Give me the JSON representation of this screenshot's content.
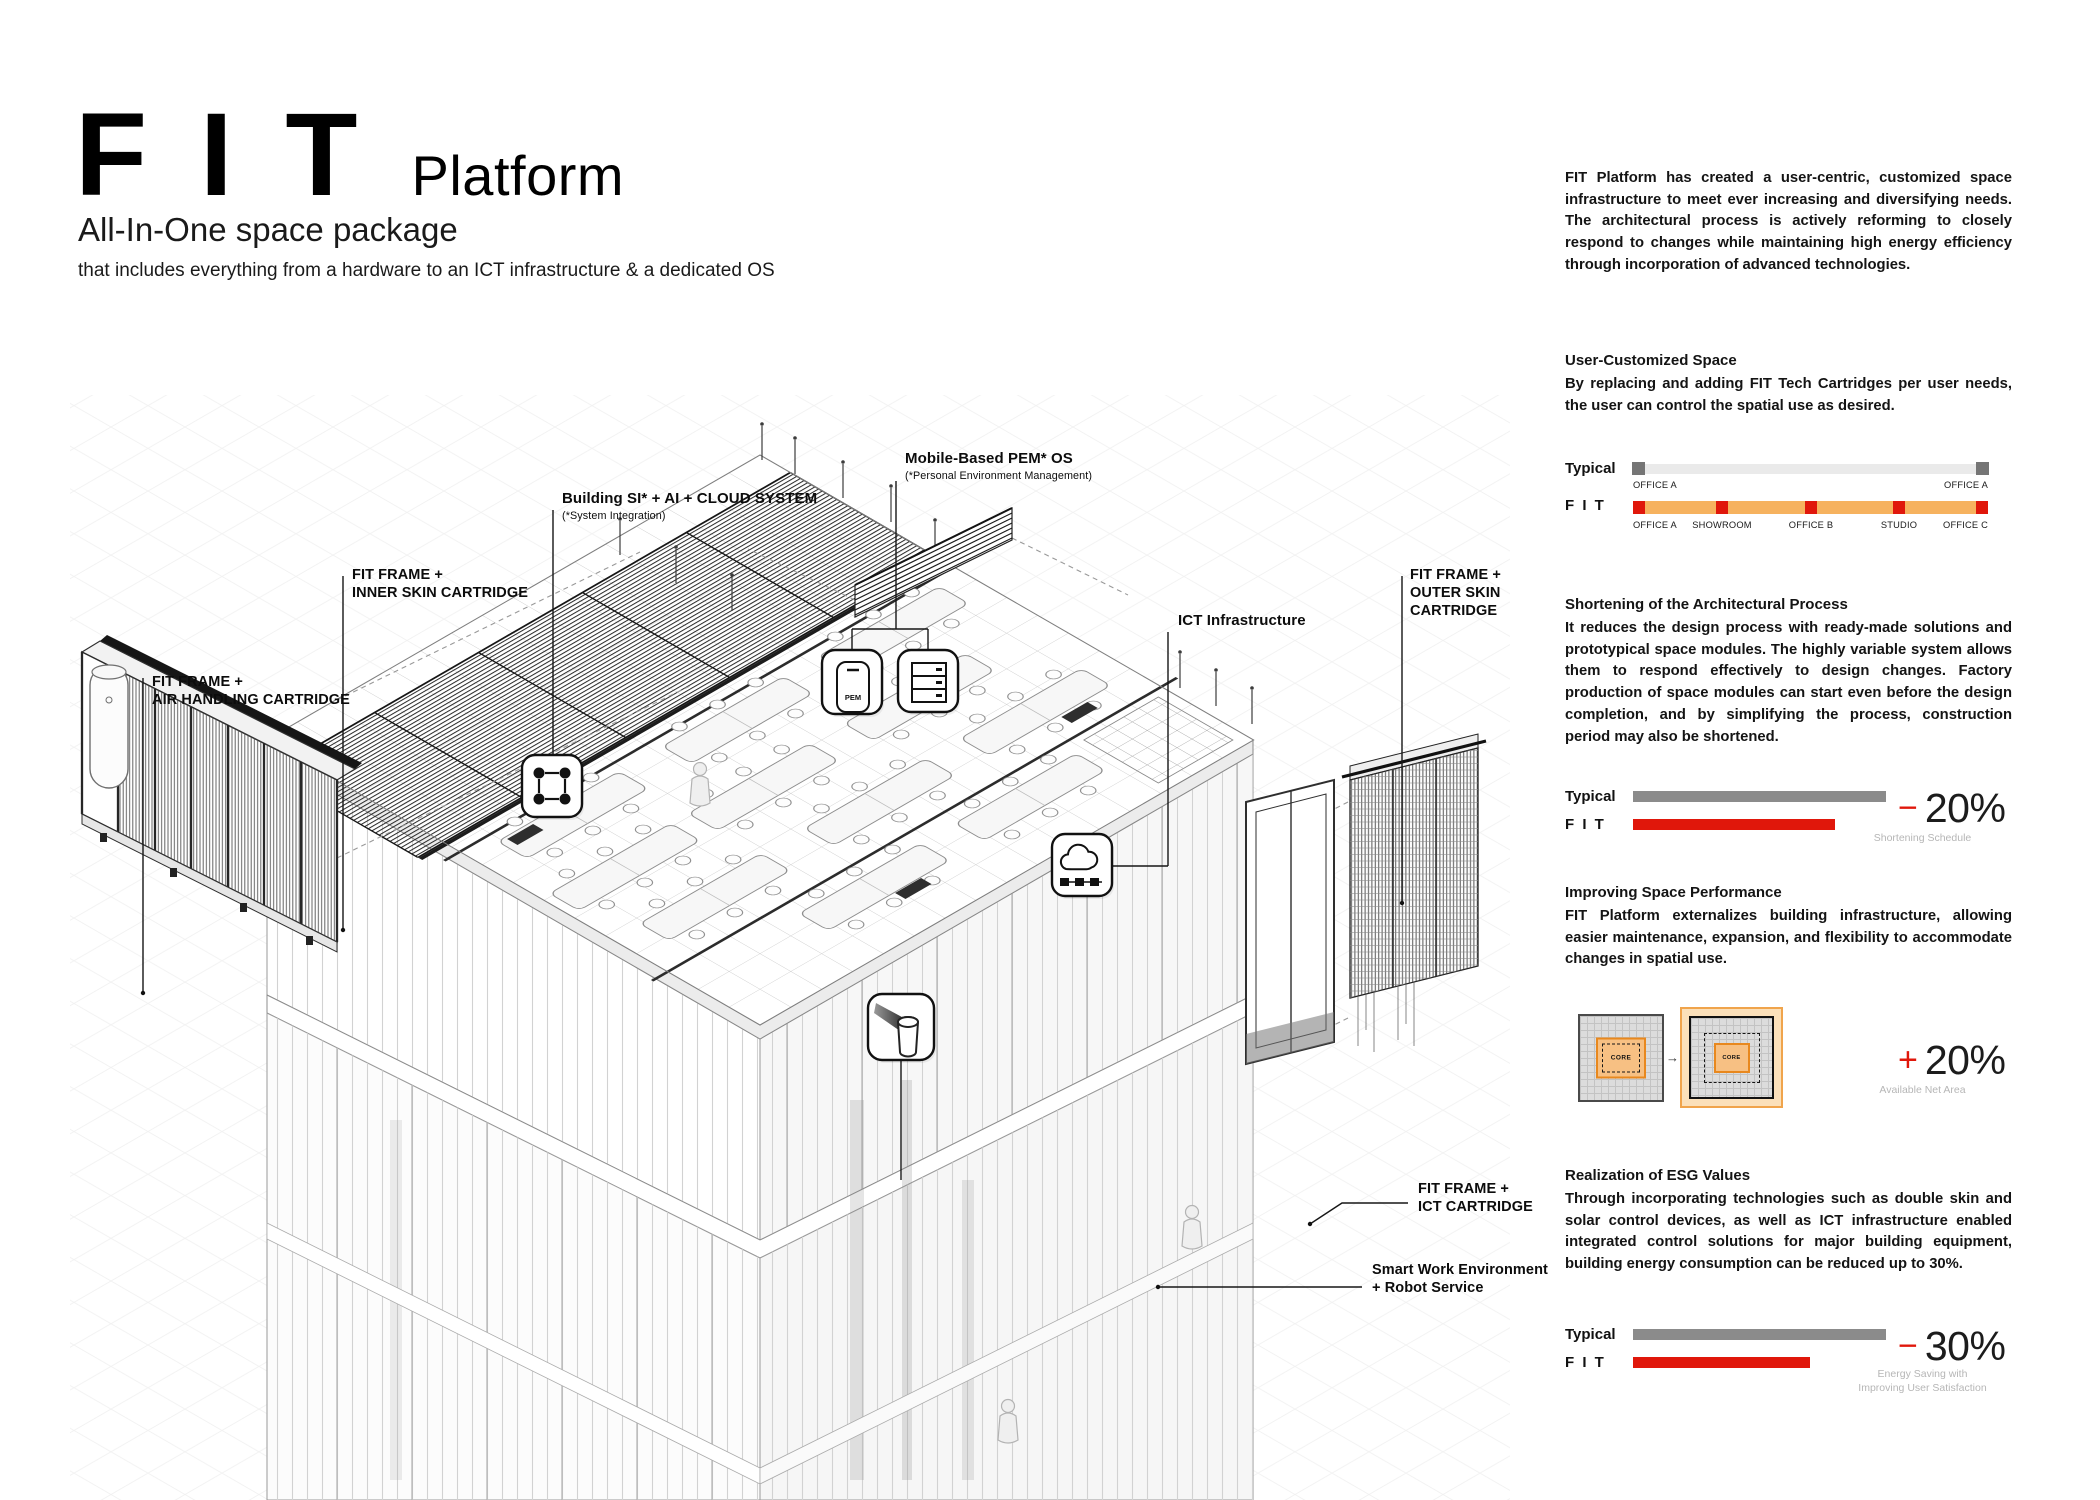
{
  "header": {
    "logo": "F I T",
    "logo_suffix": "Platform",
    "tagline": "All-In-One space package",
    "subtitle": "that includes everything from a hardware to an ICT infrastructure & a dedicated OS"
  },
  "intro": "FIT Platform has created a user-centric, customized space infrastructure to meet ever increasing and diversifying needs. The architectural process is actively reforming to closely respond to changes while maintaining high energy efficiency through incorporation of advanced technologies.",
  "rows": {
    "typical": "Typical",
    "fit": "F I T"
  },
  "sections": {
    "user_customized": {
      "heading": "User-Customized Space",
      "body": "By replacing and adding FIT Tech Cartridges per user needs, the user can control the spatial use as desired.",
      "typical_labels": [
        "OFFICE A",
        "OFFICE A"
      ],
      "fit_labels": [
        "OFFICE A",
        "SHOWROOM",
        "OFFICE B",
        "STUDIO",
        "OFFICE C"
      ]
    },
    "shortening": {
      "heading": "Shortening of the Architectural Process",
      "body": "It reduces the design process with ready-made solutions and prototypical space modules. The highly variable system allows them to respond effectively to design changes. Factory production of space modules can start even before the design completion, and by simplifying the process, construction period may also be shortened.",
      "sign": "−",
      "value": "20%",
      "caption": "Shortening Schedule",
      "typical_bar_percent": 100,
      "fit_bar_percent": 80
    },
    "space_performance": {
      "heading": "Improving Space Performance",
      "body": "FIT Platform externalizes building infrastructure, allowing easier maintenance, expansion, and flexibility to accommodate changes in spatial use.",
      "sign": "+",
      "value": "20%",
      "caption": "Available Net Area",
      "core_label": "CORE",
      "arrow_char": "→"
    },
    "esg": {
      "heading": "Realization of ESG Values",
      "body": "Through incorporating technologies such as double skin and solar control devices, as well as ICT infrastructure enabled integrated control solutions for major building equipment, building energy consumption can be reduced up to 30%.",
      "sign": "−",
      "value": "30%",
      "caption_line1": "Energy Saving with",
      "caption_line2": "Improving User Satisfaction",
      "typical_bar_percent": 100,
      "fit_bar_percent": 70
    }
  },
  "drawing": {
    "labels": {
      "air_handling_1": "FIT FRAME +",
      "air_handling_2": "AIR HANDLING CARTRIDGE",
      "inner_skin_1": "FIT FRAME +",
      "inner_skin_2": "INNER SKIN CARTRIDGE",
      "building_si_1": "Building SI* + AI + CLOUD SYSTEM",
      "building_si_2": "(*System Integration)",
      "pem_1": "Mobile-Based PEM* OS",
      "pem_2": "(*Personal Environment Management)",
      "ict_infra": "ICT Infrastructure",
      "outer_skin_1": "FIT FRAME +",
      "outer_skin_2": "OUTER SKIN",
      "outer_skin_3": "CARTRIDGE",
      "ict_cartridge_1": "FIT FRAME +",
      "ict_cartridge_2": "ICT CARTRIDGE",
      "smart_work_1": "Smart Work Environment",
      "smart_work_2": "+ Robot Service"
    },
    "pem_icon_text": "PEM"
  },
  "colors": {
    "accent_red": "#e0170b",
    "bar_orange": "#f6b25f",
    "bar_gray": "#8b8b8b",
    "track_gray": "#eaeaea",
    "core_orange_fill": "#f7c083",
    "core_orange_border": "#e8881e"
  }
}
